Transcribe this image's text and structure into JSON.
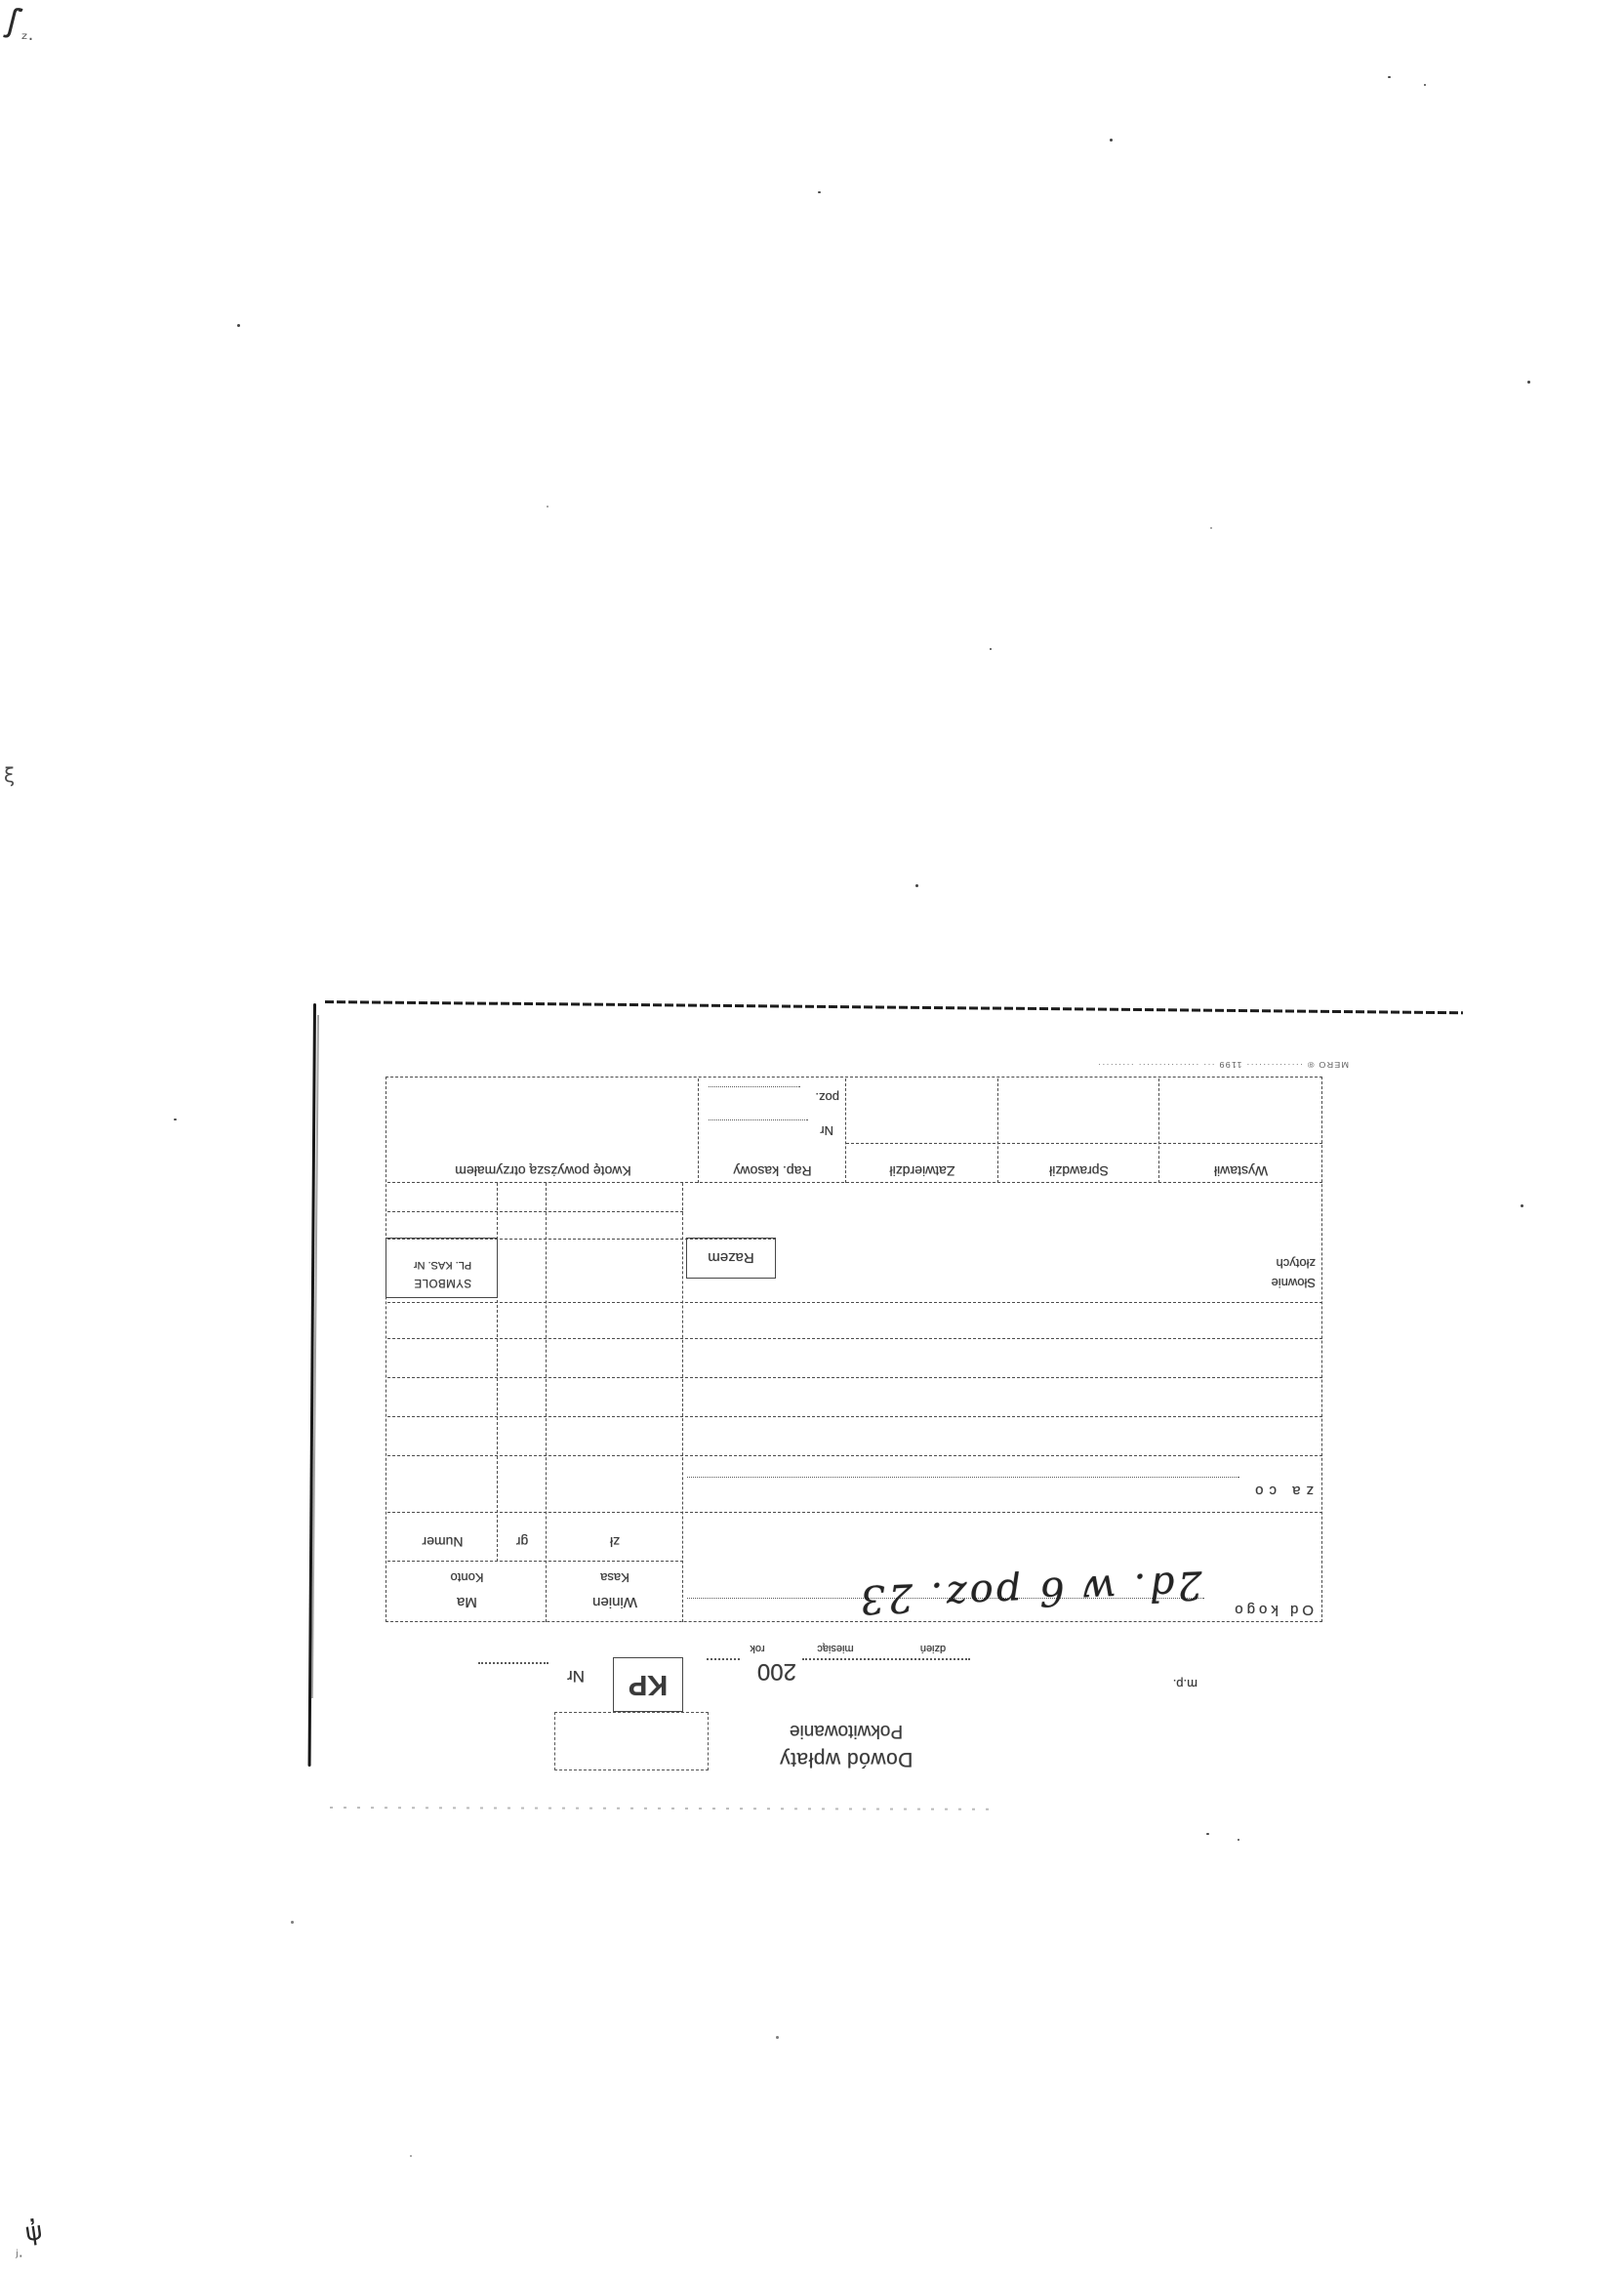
{
  "form": {
    "title_line1": "Dowód wpłaty",
    "title_line2": "Pokwitowanie",
    "doc_symbol": "KP",
    "nr_label": "Nr",
    "date": {
      "year_prefix": "200",
      "day": "dzień",
      "month": "miesiąc",
      "year": "rok"
    },
    "mp_label": "m.p.",
    "od_kogo_label": "Od kogo",
    "handwritten_note": "2d. w 6 poz. 23",
    "za_co_label": "za co",
    "debit_main": "Winien",
    "debit_sub": "Kasa",
    "credit_main": "Ma",
    "credit_sub": "Konto",
    "col_zl": "zł",
    "col_gr": "gr",
    "col_numer": "Numer",
    "slownie_line1": "Słownie",
    "slownie_line2": "złotych",
    "razem_label": "Razem",
    "symbole_line1": "SYMBOLE",
    "symbole_line2": "PL. KAS. Nr",
    "footer_boxes": [
      "Wystawił",
      "Sprawdził",
      "Zatwierdził",
      "Rap. kasowy",
      "Kwotę powyższą otrzymałem"
    ],
    "rap_nr_label": "Nr",
    "rap_poz_label": "poz.",
    "imprint": "MERO ® ·············· 1199 ··· ··············· ·········"
  }
}
